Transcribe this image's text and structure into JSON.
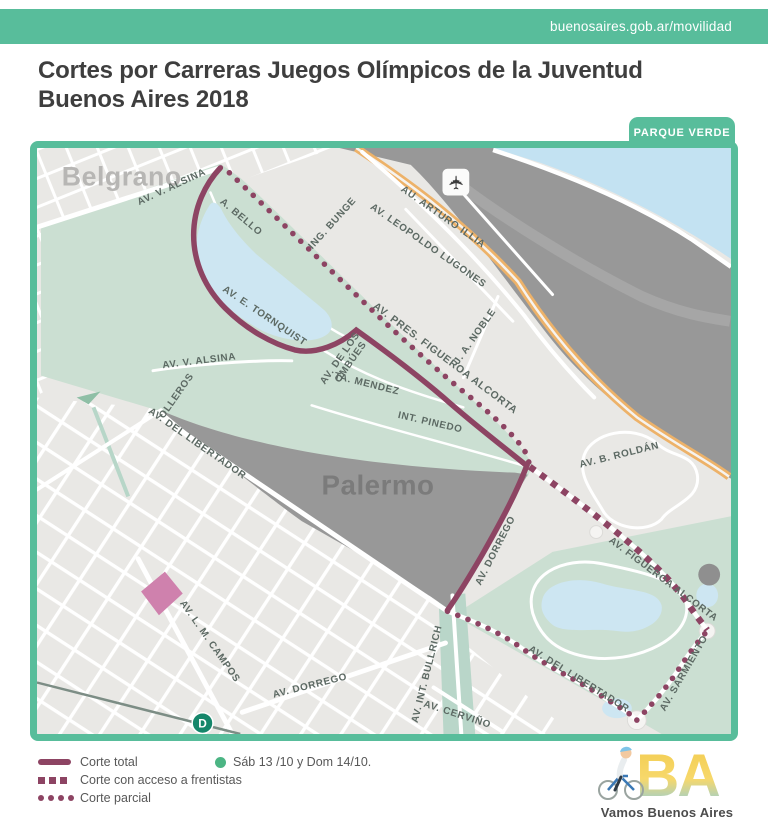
{
  "header": {
    "url": "buenosaires.gob.ar/movilidad"
  },
  "title": {
    "line1": "Cortes por Carreras Juegos Olímpicos de la Juventud",
    "line2": "Buenos Aires 2018"
  },
  "map": {
    "corner_tag": "PARQUE VERDE",
    "districts": {
      "belgrano": "Belgrano",
      "palermo": "Palermo"
    },
    "airport_icon": "✈",
    "subway": {
      "line": "D"
    },
    "streets": [
      {
        "name": "AV. V. ALSINA"
      },
      {
        "name": "A. BELLO"
      },
      {
        "name": "ING. BUNGE"
      },
      {
        "name": "AU. ARTURO ILLIA"
      },
      {
        "name": "AV. LEOPOLDO LUGONES"
      },
      {
        "name": "AV. PRES. FIGUEROA ALCORTA"
      },
      {
        "name": "J. A. NOBLE"
      },
      {
        "name": "AV. E. TORNQUIST"
      },
      {
        "name": "AV. DE LOS OMBÚES",
        "line1": "AV. DE LOS",
        "line2": "OMBÚES"
      },
      {
        "name": "TA. MENDEZ"
      },
      {
        "name": "INT. PINEDO"
      },
      {
        "name": "AV. V. ALSINA"
      },
      {
        "name": "OLLEROS"
      },
      {
        "name": "AV. DEL LIBERTADOR"
      },
      {
        "name": "AV. B. ROLDÁN"
      },
      {
        "name": "AV. DORREGO"
      },
      {
        "name": "AV. FIGUEROA ALCORTA"
      },
      {
        "name": "AV. L. M. CAMPOS"
      },
      {
        "name": "AV. DORREGO"
      },
      {
        "name": "AV. INT. BULLRICH"
      },
      {
        "name": "AV. CERVIÑO"
      },
      {
        "name": "AV. DEL LIBERTADOR"
      },
      {
        "name": "AV. SARMIENTO"
      }
    ]
  },
  "legend": {
    "items": [
      {
        "style": "solid",
        "label": "Corte total"
      },
      {
        "style": "dashed",
        "label": "Corte con acceso a frentistas"
      },
      {
        "style": "dotted",
        "label": "Corte parcial"
      }
    ],
    "schedule": "Sáb 13 /10 y Dom 14/10."
  },
  "footer": {
    "logo": "BA",
    "slogan": "Vamos Buenos Aires"
  },
  "colors": {
    "teal": "#58bd9b",
    "route_maroon": "#8d4463",
    "park_green": "#cbdfd2",
    "water_blue": "#c3e2f2",
    "dark_area": "#989898",
    "highway_orange": "#edb269",
    "pink_block": "#cf81ad",
    "subway_green": "#15866a",
    "schedule_dot": "#4cb584",
    "logo_yellow": "#f2cb4e",
    "logo_blue": "#85cde9"
  }
}
